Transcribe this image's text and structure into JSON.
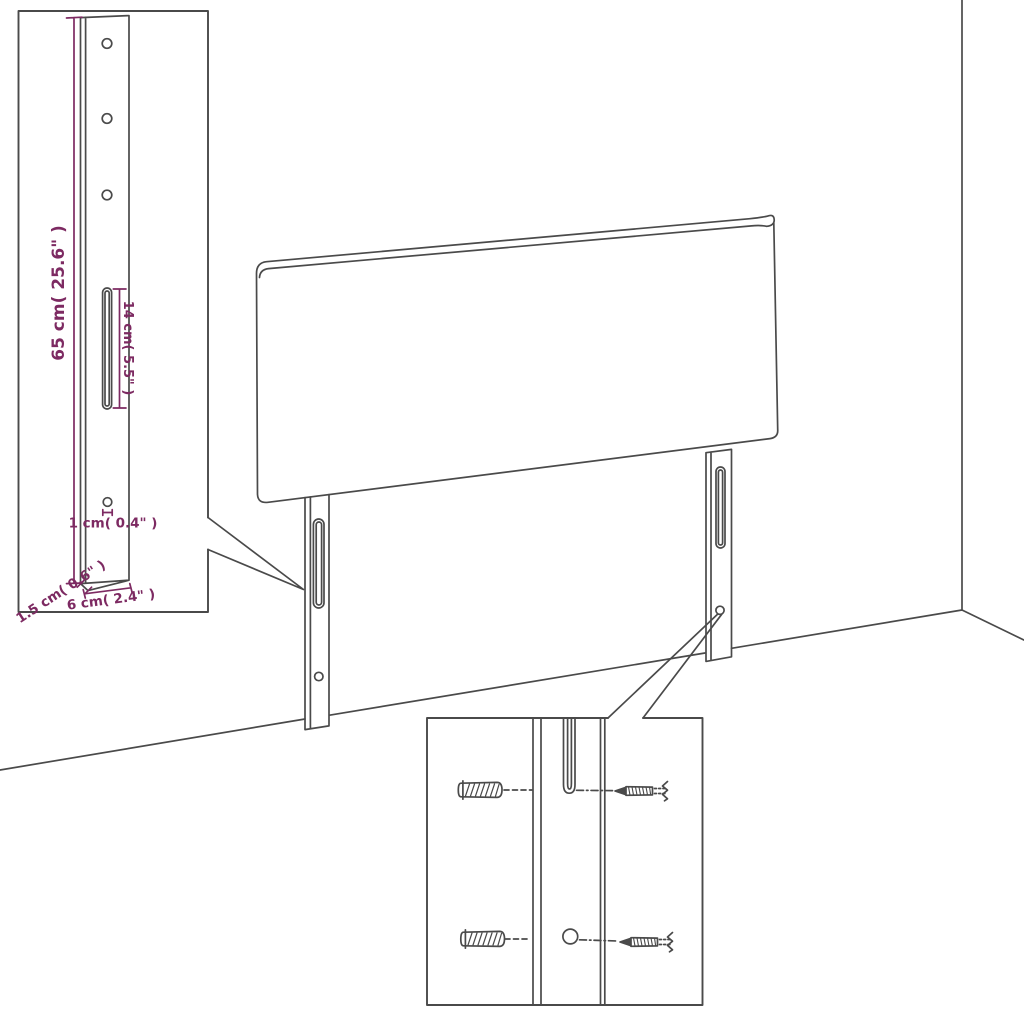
{
  "diagram": {
    "type": "furniture assembly dimension diagram",
    "subject": "Upholstered headboard with two mounting legs shown against a room corner, with a leg-dimension inset (top left) and a wall-mounting hardware inset (bottom)",
    "colors": {
      "line": "#4a4a4a",
      "dimension": "#7d2a62",
      "background": "#ffffff"
    },
    "leg_detail": {
      "height_label": "65 cm( 25.6\" )",
      "slot_label": "14 cm( 5.5\" )",
      "hole_label": "1 cm( 0.4\" )",
      "thickness_label": "1.5 cm( 0.6\" )",
      "width_label": "6 cm( 2.4\" )"
    },
    "mounting_detail": {
      "hardware": [
        "wall-plug",
        "screw"
      ],
      "features": [
        "keyhole-slot",
        "screw-hole"
      ]
    }
  }
}
